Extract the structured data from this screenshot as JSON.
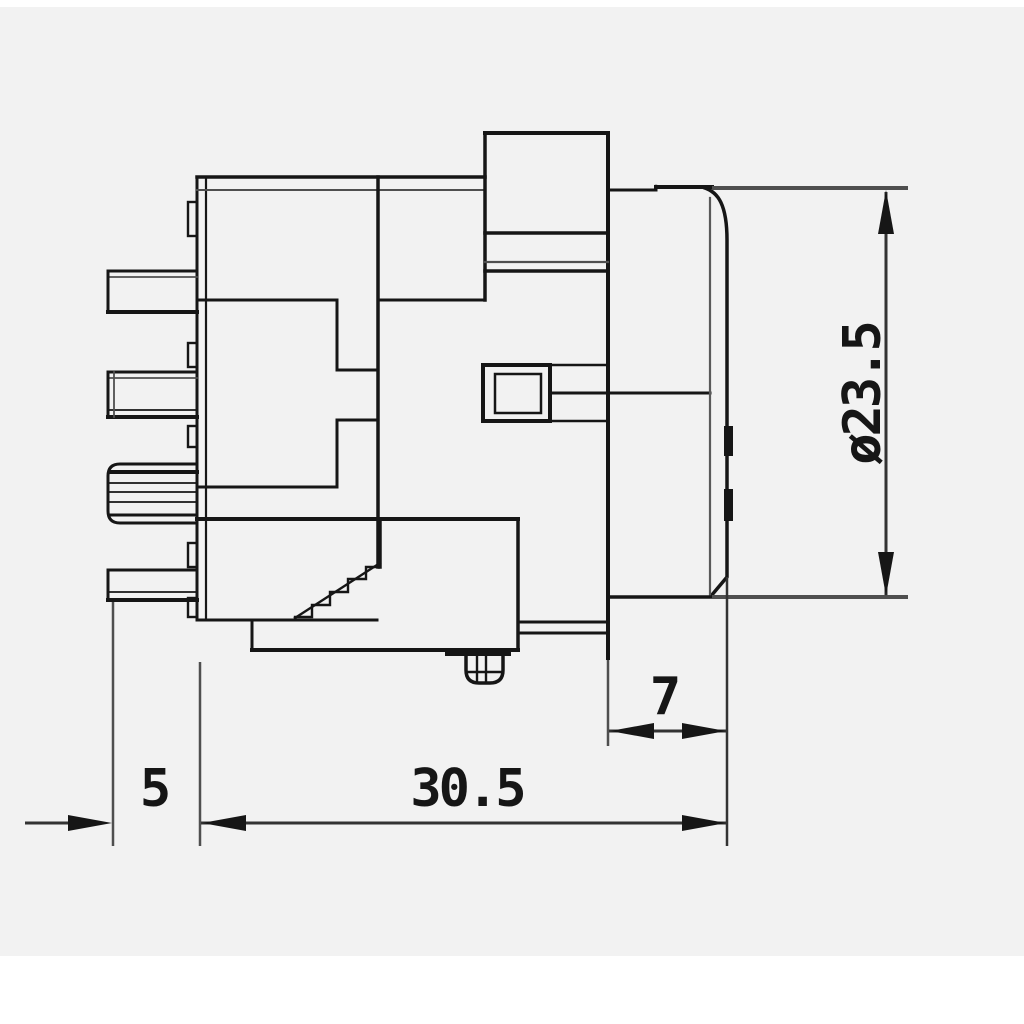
{
  "canvas": {
    "background": "#ffffff",
    "paper": "#f2f2f2",
    "line_dark": "#161616",
    "line_gray": "#4f4f4f"
  },
  "drawing": {
    "kind": "connector side-view technical drawing",
    "dimensions": {
      "diameter": {
        "label": "ø23.5"
      },
      "front_depth": {
        "label": "7"
      },
      "rear_offset": {
        "label": "5"
      },
      "body_length": {
        "label": "30.5"
      }
    }
  }
}
